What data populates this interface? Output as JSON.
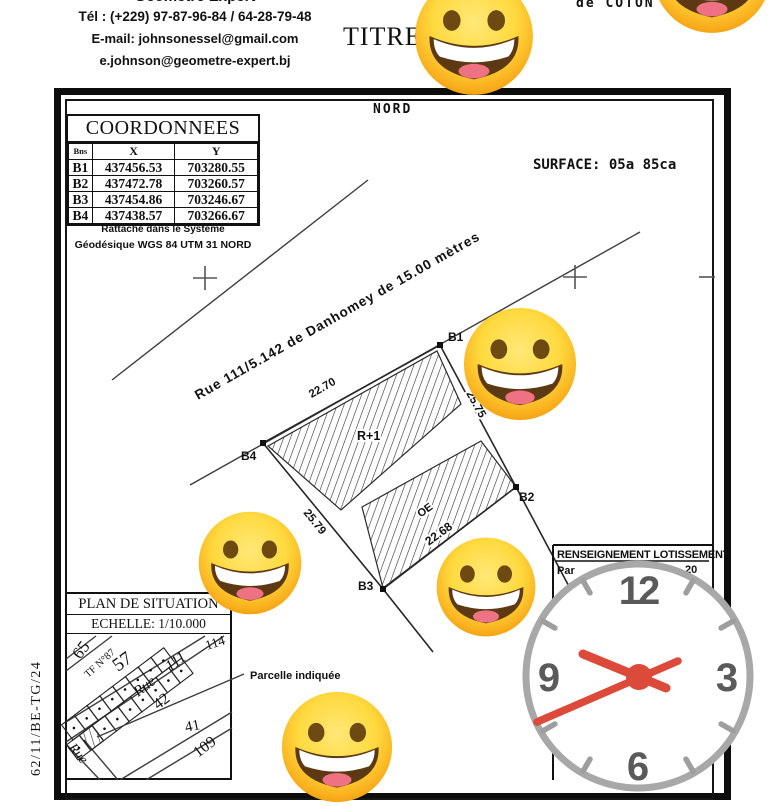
{
  "header": {
    "firm_cut_line": "Géomètre Expert",
    "phone": "Tél : (+229) 97-87-96-84 / 64-28-79-48",
    "email_primary": "E-mail: johnsonessel@gmail.com",
    "email_secondary": "e.johnson@geometre-expert.bj",
    "title_fragment": "TITRE",
    "top_right_fragment": "de COTON"
  },
  "plan": {
    "north": "NORD",
    "surface": "SURFACE: 05a 85ca",
    "coordinates": {
      "title": "COORDONNEES",
      "columns": [
        "Bns",
        "X",
        "Y"
      ],
      "rows": [
        [
          "B1",
          "437456.53",
          "703280.55"
        ],
        [
          "B2",
          "437472.78",
          "703260.57"
        ],
        [
          "B3",
          "437454.86",
          "703246.67"
        ],
        [
          "B4",
          "437438.57",
          "703266.67"
        ]
      ],
      "datum_line1": "Rattaché dans le Système",
      "datum_line2": "Géodésique WGS 84 UTM 31 NORD"
    },
    "street": "Rue 111/5.142   de  Danhomey  de  15.00   mètres",
    "parcel": {
      "b1": "B1",
      "b2": "B2",
      "b3": "B3",
      "b4": "B4",
      "m_top": "22.70",
      "m_right": "25.75",
      "m_left": "25.79",
      "m_bottom": "22.68",
      "building": "R+1",
      "strip": "OE"
    },
    "renseignement": {
      "title": "RENSEIGNEMENT LOTISSEMENT",
      "frag_left": "Par",
      "frag_right": "20"
    },
    "situation": {
      "title": "PLAN DE SITUATION",
      "scale": "ECHELLE: 1/10.000",
      "pointer": "Parcelle indiquée",
      "labels": {
        "l65": "65",
        "tf": "TF N°87",
        "l57": "57",
        "rue_top": "Rue",
        "l111": "111",
        "l114": "114",
        "l42": "42",
        "l41": "41",
        "l109": "109",
        "rue_bottom": "Rue"
      }
    },
    "reference": "62/11/BE-TG/24"
  },
  "clock": {
    "n12": "12",
    "n3": "3",
    "n6": "6",
    "n9": "9"
  },
  "colors": {
    "ink": "#111111",
    "hand_red": "#dc4a3a",
    "ring_gray": "#a8a8a8",
    "number_gray": "#5a5a5a",
    "emoji_yellow": "#ffd93e",
    "emoji_orange": "#f29c0f"
  }
}
